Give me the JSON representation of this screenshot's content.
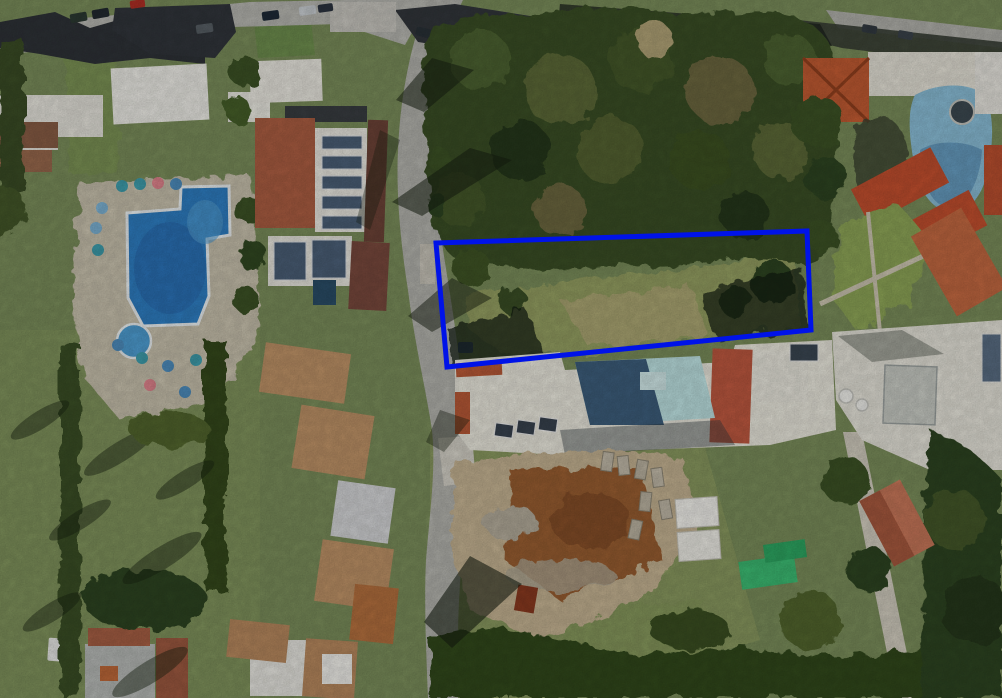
{
  "scene": {
    "description": "Aerial satellite photograph of a Mediterranean resort neighbourhood; an empty tree-covered plot in the centre is outlined with a thick blue rectangle",
    "view": "top-down satellite imagery, sunlight from upper right casting shadows to lower left"
  },
  "annotation": {
    "name": "highlighted-plot-boundary",
    "shape": "quadrilateral outline",
    "points": "436,243 807,231 811,330 447,367",
    "stroke_color": "#0013e8",
    "stroke_width": 5
  },
  "palette": {
    "annotation_blue": "#0013e8",
    "road_grey": "#b5b5af",
    "pavement_light": "#d3d0c6",
    "deck_tan": "#c9c2ae",
    "pool_blue": "#2f7fc4",
    "pool_blue_dark": "#2a6cb0",
    "kid_pool_blue": "#4f9fd4",
    "small_pool_light": "#bfe4e4",
    "small_pool_shadow": "#3e5f7d",
    "lagoon_pool": "#8cc0da",
    "lagoon_pool_dark": "#5e93ba",
    "grass_base": "#7c8f5c",
    "grass_light": "#96a163",
    "field_tan": "#b2aa78",
    "tree_dark": "#2e4424",
    "tree_mid": "#48602f",
    "tree_olive": "#5d6b38",
    "roof_orange": "#c35c33",
    "roof_red": "#c4502f",
    "roof_terracotta": "#c05a41",
    "roof_sandy_tile": "#c09468",
    "roof_dark_charcoal": "#30343a",
    "building_white": "#efeee8",
    "solar_panel": "#4c6078",
    "dirt_brown": "#9a5f33",
    "dirt_tan": "#c7b594",
    "rubble_grey": "#c3bbaa",
    "green_shed": "#3dbd74",
    "shadow": "rgba(24,32,18,0.55)"
  },
  "landmarks": [
    {
      "name": "top-street-with-parked-cars",
      "area": "top left edge"
    },
    {
      "name": "dark-charcoal-roof-houses",
      "area": "top left"
    },
    {
      "name": "large-resort-pool",
      "area": "left, irregular blue pool with white rim and round kids pool"
    },
    {
      "name": "pool-umbrellas",
      "area": "teal, blue and pink parasols around left pool"
    },
    {
      "name": "solar-panel-building",
      "area": "centre left, white roof with rows of panels"
    },
    {
      "name": "main-road",
      "area": "vertical road curving through centre left"
    },
    {
      "name": "terracotta-roof-row",
      "area": "lower left along road"
    },
    {
      "name": "highlighted-empty-plot",
      "area": "centre, trees and scrub inside blue outline"
    },
    {
      "name": "white-villa-with-small-pool",
      "area": "below highlighted plot"
    },
    {
      "name": "construction-site",
      "area": "bottom centre, brown earth and stone rubble"
    },
    {
      "name": "white-twin-roof-structure",
      "area": "construction site right"
    },
    {
      "name": "bright-green-sheds",
      "area": "right of construction site"
    },
    {
      "name": "lagoon-pool-with-jacuzzi",
      "area": "top right"
    },
    {
      "name": "orange-hip-roof-villa",
      "area": "top right"
    },
    {
      "name": "lawn-garden",
      "area": "right centre with crossing paths"
    },
    {
      "name": "red-gable-house",
      "area": "bottom right"
    },
    {
      "name": "green-fields",
      "area": "bottom left with long tree shadows"
    }
  ]
}
